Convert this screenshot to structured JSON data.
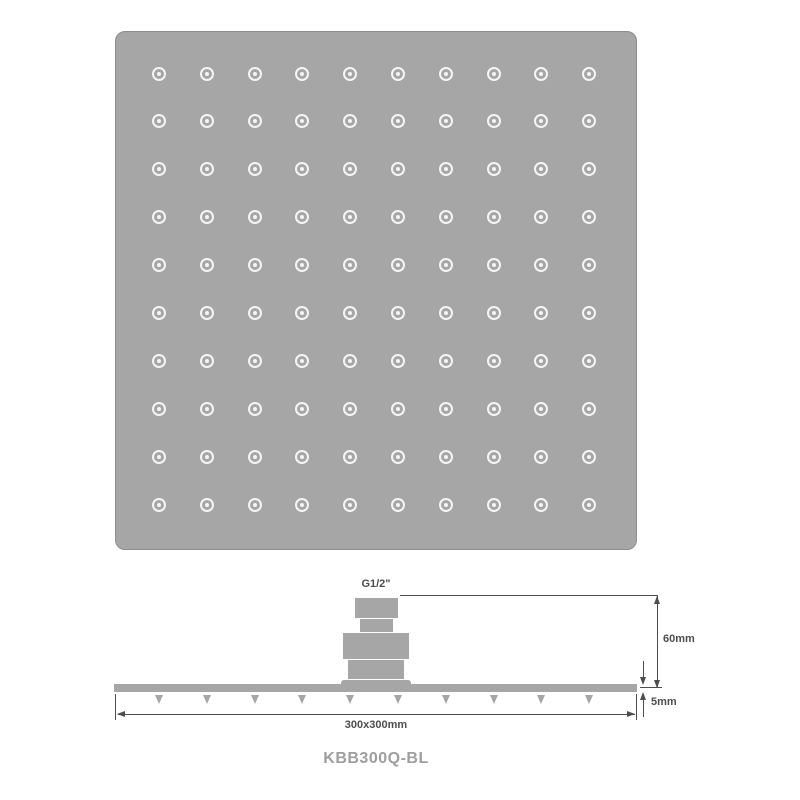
{
  "product_code": "KBB300Q-BL",
  "top_view": {
    "nozzle_rows": 10,
    "nozzle_cols": 10
  },
  "side_view": {
    "connector_label": "G1/2\"",
    "spray_nozzle_count": 10,
    "dimensions": {
      "height": "60mm",
      "thickness": "5mm",
      "face": "300x300mm"
    }
  },
  "colors": {
    "body": "#a6a6a6",
    "body_border": "#8e8e8e",
    "nozzle": "#f5f5f5",
    "line": "#4d4d4d",
    "code_text": "#9e9e9e",
    "background": "#ffffff"
  }
}
